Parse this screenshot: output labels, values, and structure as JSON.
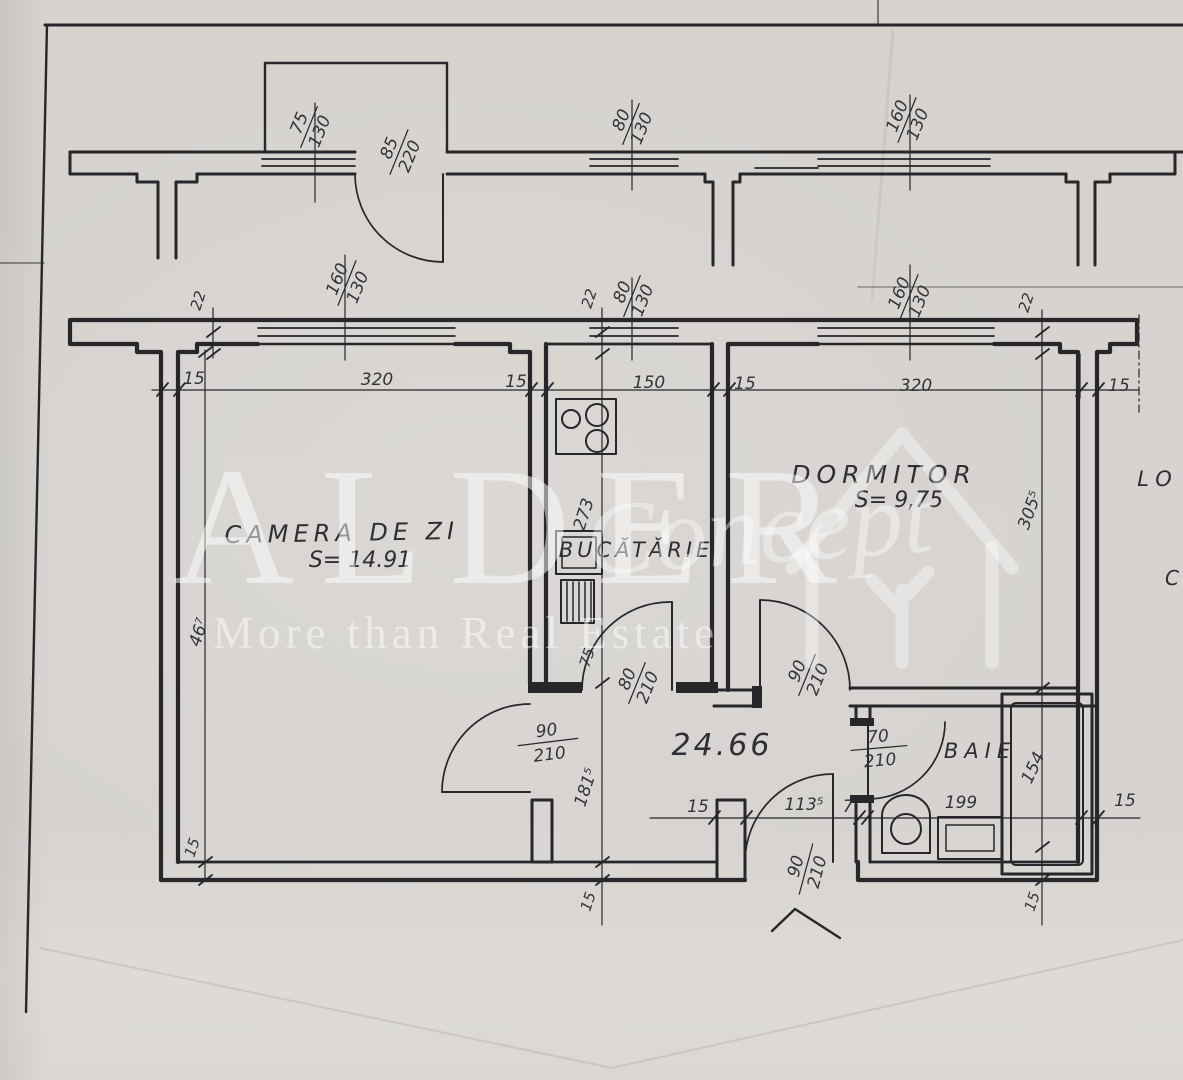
{
  "document_type": "scanned apartment floor plan",
  "colors": {
    "paper": "#d7d4d1",
    "ink": "#26262b",
    "watermark": "#ffffff"
  },
  "watermark": {
    "brand": "ALDER",
    "brand_script": "Concept",
    "tagline": "More than Real Estate"
  },
  "rooms": {
    "living": {
      "name": "CAMERA DE ZI",
      "area": "S= 14.91"
    },
    "kitchen": {
      "name": "BUCĂTĂRIE"
    },
    "bedroom": {
      "name": "DORMITOR",
      "area": "S= 9,75"
    },
    "bath": {
      "name": "BAIE"
    },
    "hall": {
      "area_label": "24.66"
    }
  },
  "edge": {
    "text1": "LO",
    "text2": "C"
  },
  "windows": {
    "balcony": {
      "w": "75",
      "h": "130"
    },
    "balcony_door": {
      "w": "85",
      "h": "220"
    },
    "upper_kitchen": {
      "w": "80",
      "h": "130"
    },
    "upper_right": {
      "w": "160",
      "h": "130"
    },
    "living": {
      "w": "160",
      "h": "130"
    },
    "kitchen": {
      "w": "80",
      "h": "130"
    },
    "bedroom": {
      "w": "160",
      "h": "130"
    }
  },
  "doors": {
    "living": {
      "w": "90",
      "h": "210"
    },
    "kitchen": {
      "w": "80",
      "h": "210"
    },
    "bedroom": {
      "w": "90",
      "h": "210"
    },
    "bath": {
      "w": "70",
      "h": "210"
    },
    "entrance": {
      "w": "90",
      "h": "210"
    }
  },
  "dims": {
    "wall_thickness": "22",
    "row_390": [
      "15",
      "320",
      "15",
      "150",
      "15",
      "320",
      "15"
    ],
    "living_depth": "46⁷",
    "living_bottom_wall": "15",
    "kitchen_depth": "273",
    "kitchen_jamb": "75",
    "hall_depth": "181⁵",
    "hall_bottom_wall": "15",
    "bedroom_depth": "305⁵",
    "entry_pillar": "15",
    "entry_width": "113⁵",
    "entry_wall": "7",
    "bath_width": "199",
    "tub_length": "154",
    "right_wall": "15",
    "bottom_right_wall": "15"
  }
}
